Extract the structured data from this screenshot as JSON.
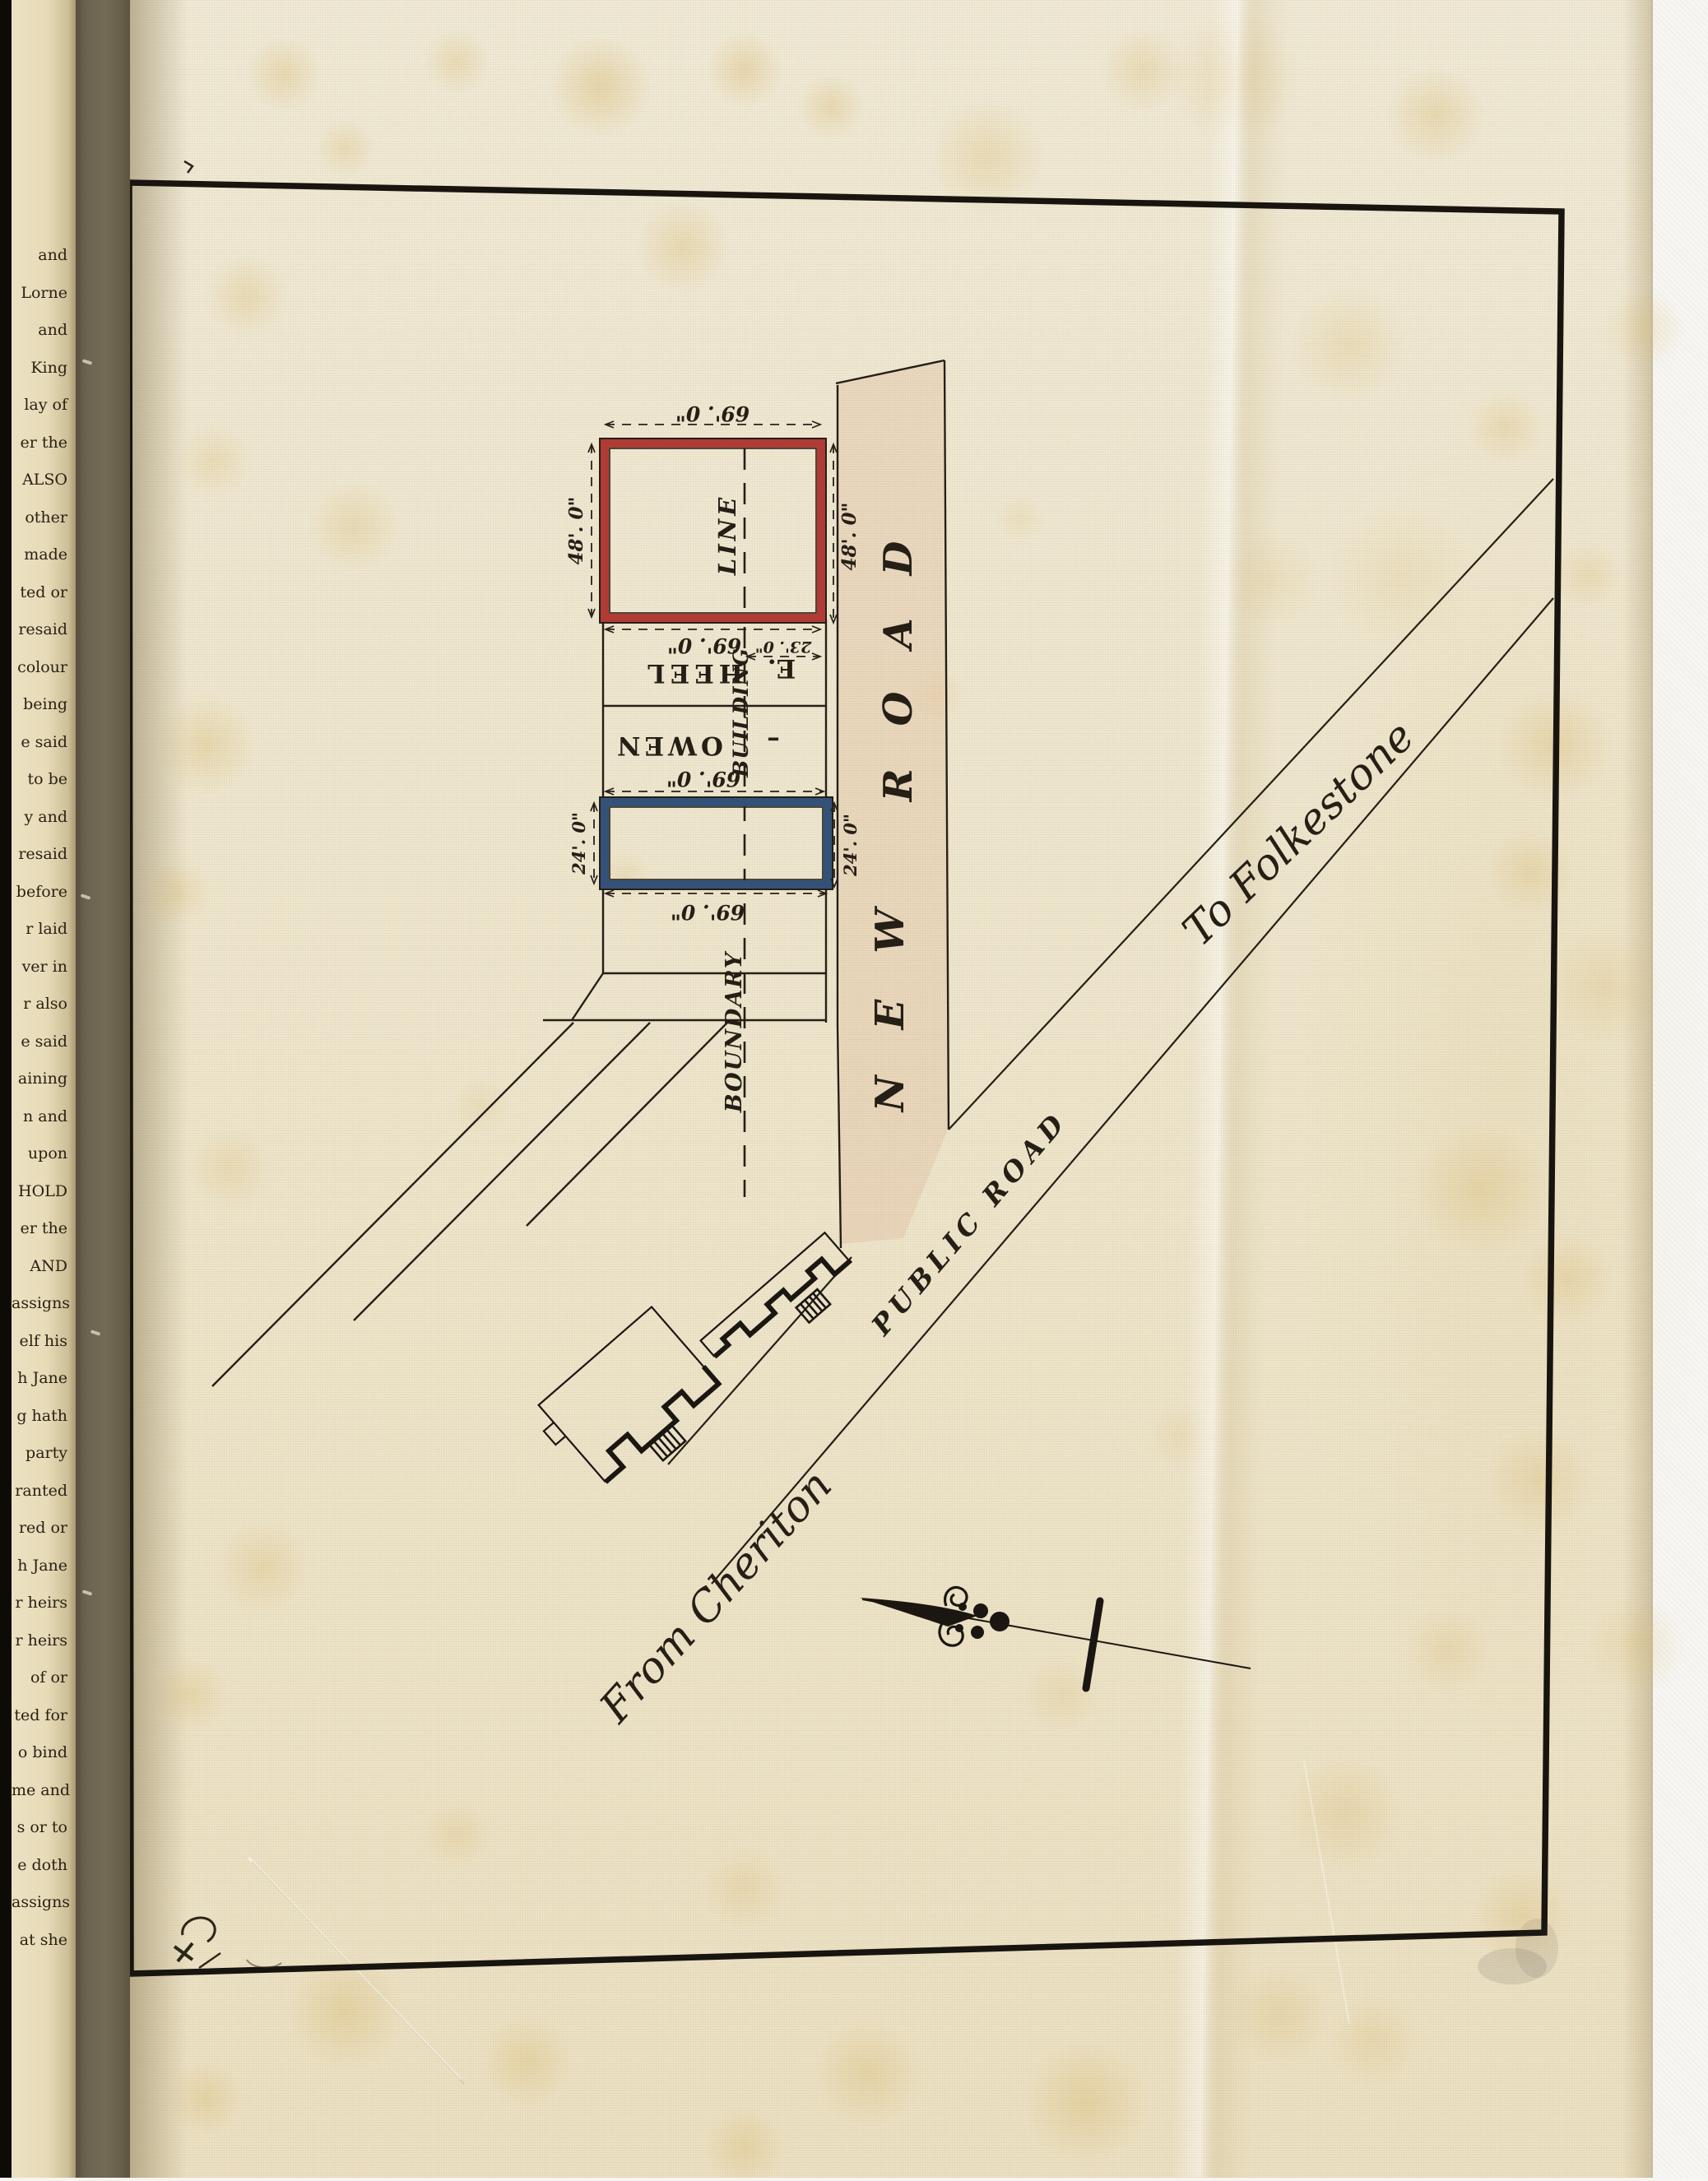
{
  "spine": {
    "fragments": [
      "and",
      "Lorne",
      "and",
      "King",
      "lay of",
      "er the",
      "ALSO",
      "other",
      "made",
      "ted or",
      "resaid",
      "colour",
      "being",
      "e said",
      "to be",
      "y and",
      "resaid",
      "before",
      "r laid",
      "ver in",
      "r also",
      "e said",
      "aining",
      "n and",
      "upon",
      "HOLD",
      "er the",
      "AND",
      "assigns",
      "elf his",
      "h Jane",
      "g hath",
      "party",
      "ranted",
      "red or",
      "h Jane",
      "r heirs",
      "r heirs",
      "of or",
      "ted for",
      "o bind",
      "me and",
      "s or to",
      "e doth",
      "assigns",
      "at she"
    ]
  },
  "plan": {
    "roads": {
      "new_word1": "NEW",
      "new_word2": "ROAD",
      "public": "PUBLIC ROAD",
      "to_folkestone": "To Folkestone",
      "from_cheriton": "From Cheriton"
    },
    "labels": {
      "building": "BUILDING",
      "line": "LINE",
      "boundary": "BOUNDARY",
      "heel": "HEEL",
      "e_initial": "E.",
      "owen": "OWEN",
      "dash": "–"
    },
    "dims": {
      "d69": "69'. 0\"",
      "d48": "48'. 0\"",
      "d23": "23'. 0\"",
      "d24": "24'. 0\""
    },
    "colors": {
      "red_plot": "#b23a35",
      "blue_plot": "#31517a",
      "ink": "#221d15",
      "road_wash": "#dfb897"
    }
  }
}
